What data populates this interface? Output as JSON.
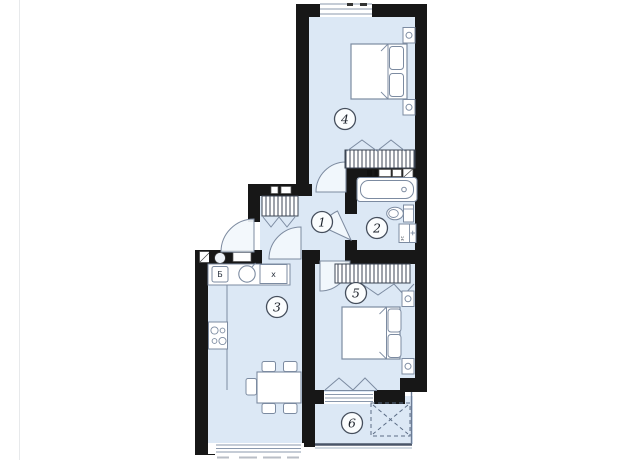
{
  "page": {
    "background": "#ffffff"
  },
  "plan": {
    "type": "apartment-floor-plan",
    "colors": {
      "wall": "#171717",
      "floor": "#dce8f5",
      "furniture_line": "#7c8ba1",
      "hatch_line": "#3c4654",
      "accent_dark_edge": "#4a5568"
    },
    "rooms": [
      {
        "number": "1",
        "name": "hallway"
      },
      {
        "number": "2",
        "name": "bathroom"
      },
      {
        "number": "3",
        "name": "kitchen-living-room"
      },
      {
        "number": "4",
        "name": "bedroom"
      },
      {
        "number": "5",
        "name": "bedroom"
      },
      {
        "number": "6",
        "name": "balcony"
      }
    ],
    "labels": {
      "kitchen_box": "x",
      "kitchen_appliance": "Б",
      "washer": "зс"
    },
    "furniture": {
      "room_1": [
        "built-in-wardrobe",
        "entrance-door"
      ],
      "room_2": [
        "bathtub",
        "toilet",
        "washing-machine"
      ],
      "room_3": [
        "kitchen-counter",
        "sink",
        "stove",
        "dining-table",
        "chairs"
      ],
      "room_4": [
        "double-bed",
        "nightstands",
        "wardrobe",
        "window"
      ],
      "room_5": [
        "double-bed",
        "nightstands",
        "wardrobe",
        "balcony-door"
      ],
      "room_6": [
        "dashed-marked-zone"
      ]
    }
  }
}
